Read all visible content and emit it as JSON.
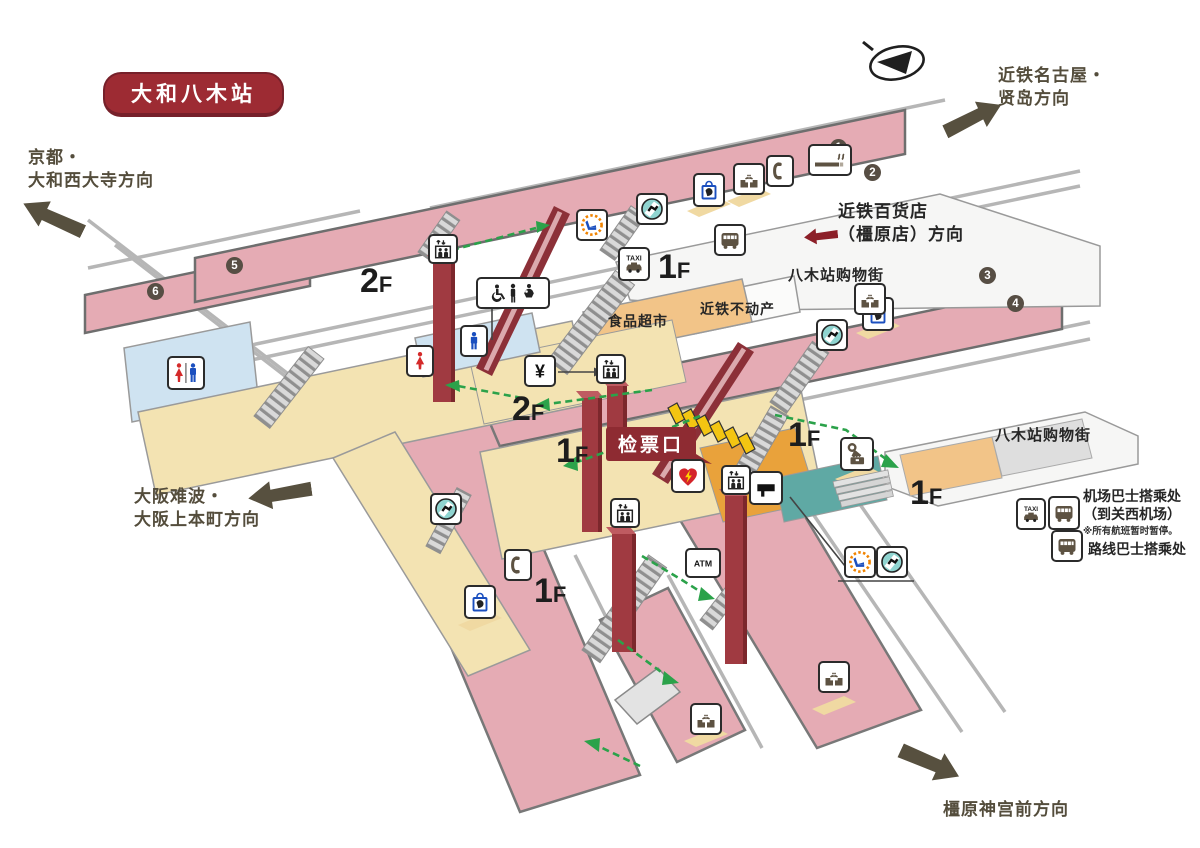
{
  "station_badge": "大和八木站",
  "directions": {
    "kyoto": {
      "line1": "京都・",
      "line2": "大和西大寺方向"
    },
    "nagoya": {
      "line1": "近铁名古屋・",
      "line2": "贤岛方向"
    },
    "namba": {
      "line1": "大阪难波・",
      "line2": "大阪上本町方向"
    },
    "kashihara": {
      "line1": "橿原神宫前方向"
    },
    "department_store": {
      "line1": "近铁百货店",
      "line2": "（橿原店）方向"
    }
  },
  "places": {
    "shopping_street_top": "八木站购物街",
    "shopping_street_right": "八木站购物街",
    "real_estate": "近铁不动产",
    "supermarket": "食品超市",
    "ticket_gate": "检票口"
  },
  "legend": {
    "airport_bus": "机场巴士搭乘处",
    "airport_bus_note": "（到关西机场）",
    "airport_bus_warning": "※所有航班暂时暂停。",
    "route_bus": "路线巴士搭乘处"
  },
  "icon_labels": {
    "taxi": "TAXI",
    "atm": "ATM",
    "fare": "¥"
  },
  "floor_labels": [
    {
      "text": "2F",
      "x": 360,
      "y": 264
    },
    {
      "text": "1F",
      "x": 658,
      "y": 250
    },
    {
      "text": "2F",
      "x": 512,
      "y": 392
    },
    {
      "text": "1F",
      "x": 556,
      "y": 434
    },
    {
      "text": "1F",
      "x": 788,
      "y": 418
    },
    {
      "text": "1F",
      "x": 910,
      "y": 476
    },
    {
      "text": "1F",
      "x": 534,
      "y": 574
    }
  ],
  "platform_numbers": [
    {
      "number": "1",
      "x": 830,
      "y": 139
    },
    {
      "number": "2",
      "x": 864,
      "y": 164
    },
    {
      "number": "3",
      "x": 979,
      "y": 267
    },
    {
      "number": "4",
      "x": 1007,
      "y": 295
    },
    {
      "number": "5",
      "x": 226,
      "y": 257
    },
    {
      "number": "6",
      "x": 147,
      "y": 283
    }
  ],
  "icons": [
    {
      "name": "elevator",
      "x": 428,
      "y": 234,
      "w": 30,
      "h": 30
    },
    {
      "name": "elevator",
      "x": 596,
      "y": 354,
      "w": 30,
      "h": 30
    },
    {
      "name": "elevator",
      "x": 610,
      "y": 498,
      "w": 30,
      "h": 30
    },
    {
      "name": "elevator",
      "x": 721,
      "y": 465,
      "w": 30,
      "h": 30
    },
    {
      "name": "accessible-restroom",
      "x": 476,
      "y": 277,
      "w": 74,
      "h": 32
    },
    {
      "name": "mens-toilet",
      "x": 460,
      "y": 325,
      "w": 28,
      "h": 32
    },
    {
      "name": "womens-toilet",
      "x": 406,
      "y": 345,
      "w": 28,
      "h": 32
    },
    {
      "name": "restroom",
      "x": 167,
      "y": 356,
      "w": 38,
      "h": 34
    },
    {
      "name": "fare-adjustment",
      "x": 524,
      "y": 355,
      "w": 32,
      "h": 32
    },
    {
      "name": "express-ticket-office",
      "x": 576,
      "y": 209,
      "w": 32,
      "h": 32
    },
    {
      "name": "express-ticket-office",
      "x": 844,
      "y": 546,
      "w": 32,
      "h": 32
    },
    {
      "name": "ticket-machine",
      "x": 636,
      "y": 193,
      "w": 32,
      "h": 32
    },
    {
      "name": "ticket-machine",
      "x": 816,
      "y": 319,
      "w": 32,
      "h": 32
    },
    {
      "name": "ticket-machine",
      "x": 430,
      "y": 493,
      "w": 32,
      "h": 32
    },
    {
      "name": "ticket-machine",
      "x": 876,
      "y": 546,
      "w": 32,
      "h": 32
    },
    {
      "name": "kiosk",
      "x": 693,
      "y": 173,
      "w": 32,
      "h": 34
    },
    {
      "name": "kiosk",
      "x": 862,
      "y": 297,
      "w": 32,
      "h": 34
    },
    {
      "name": "kiosk",
      "x": 464,
      "y": 585,
      "w": 32,
      "h": 34
    },
    {
      "name": "drinking-fountain",
      "x": 733,
      "y": 163,
      "w": 32,
      "h": 32
    },
    {
      "name": "drinking-fountain",
      "x": 854,
      "y": 283,
      "w": 32,
      "h": 32
    },
    {
      "name": "drinking-fountain",
      "x": 818,
      "y": 661,
      "w": 32,
      "h": 32
    },
    {
      "name": "drinking-fountain",
      "x": 690,
      "y": 703,
      "w": 32,
      "h": 32
    },
    {
      "name": "telephone",
      "x": 766,
      "y": 155,
      "w": 28,
      "h": 32
    },
    {
      "name": "telephone",
      "x": 504,
      "y": 549,
      "w": 28,
      "h": 32
    },
    {
      "name": "smoking-area",
      "x": 808,
      "y": 144,
      "w": 44,
      "h": 32
    },
    {
      "name": "bus-stop",
      "x": 714,
      "y": 224,
      "w": 32,
      "h": 32
    },
    {
      "name": "taxi-stand",
      "x": 618,
      "y": 247,
      "w": 32,
      "h": 34
    },
    {
      "name": "aed",
      "x": 671,
      "y": 459,
      "w": 34,
      "h": 34
    },
    {
      "name": "service-counter",
      "x": 749,
      "y": 471,
      "w": 34,
      "h": 34
    },
    {
      "name": "coin-lockers",
      "x": 840,
      "y": 437,
      "w": 34,
      "h": 34
    },
    {
      "name": "atm",
      "x": 685,
      "y": 548,
      "w": 36,
      "h": 30
    },
    {
      "name": "taxi-stand",
      "x": 1016,
      "y": 498,
      "w": 30,
      "h": 32
    },
    {
      "name": "bus-stop",
      "x": 1048,
      "y": 496,
      "w": 32,
      "h": 34
    },
    {
      "name": "bus-stop",
      "x": 1051,
      "y": 530,
      "w": 32,
      "h": 32
    }
  ],
  "colors": {
    "platform_pink": "#e5abb4",
    "concourse_yellow": "#f3e3b2",
    "accent_maroon": "#9d2b33",
    "route_green": "#2ba24a",
    "direction_olive": "#57503f"
  }
}
